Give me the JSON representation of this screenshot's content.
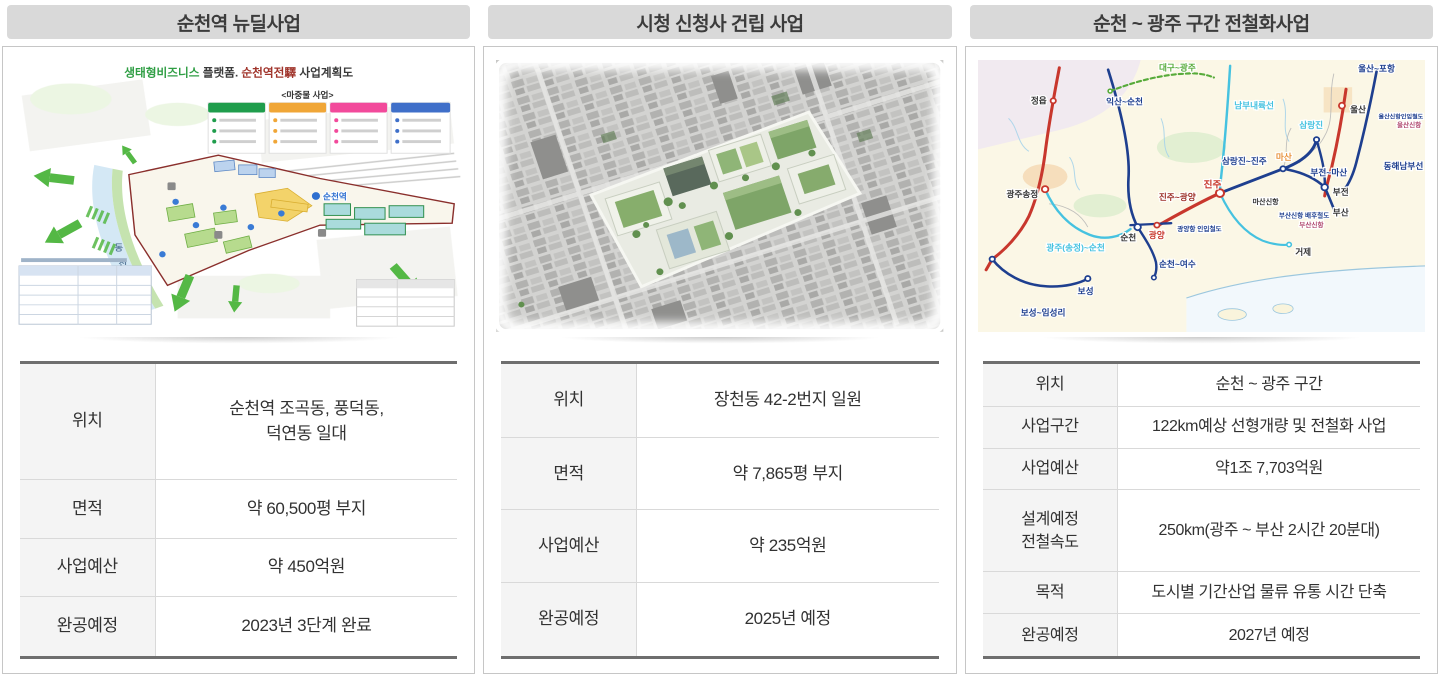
{
  "colors": {
    "header_bar": "#d9d9d9",
    "table_border": "#6e6e6e",
    "table_label_bg": "#f4f4f4",
    "legend_green": "#1f9d4c",
    "legend_orange": "#f0a637",
    "legend_pink": "#f24a9b",
    "legend_blue": "#3f6fc9",
    "rail_red": "#c8372d",
    "rail_navy": "#1e3f8f",
    "rail_cyan": "#45c2e0",
    "rail_green": "#57ab3a"
  },
  "panels": [
    {
      "title": "순천역 뉴딜사업",
      "plan": {
        "title_green": "생태형비즈니스",
        "title_mid": " 플랫폼. ",
        "title_red": "순천역전驛",
        "title_tail": " 사업계획도",
        "legend_heading": "<마중물 사업>",
        "station_label": "순천역",
        "river_char_1": "동",
        "river_char_2": "천"
      },
      "rows": [
        {
          "label": "위치",
          "value": "순천역 조곡동, 풍덕동,\n덕연동 일대"
        },
        {
          "label": "면적",
          "value": "약 60,500평 부지"
        },
        {
          "label": "사업예산",
          "value": "약 450억원"
        },
        {
          "label": "완공예정",
          "value": "2023년 3단계 완료"
        }
      ]
    },
    {
      "title": "시청 신청사 건립 사업",
      "rows": [
        {
          "label": "위치",
          "value": "장천동 42-2번지 일원"
        },
        {
          "label": "면적",
          "value": "약 7,865평 부지"
        },
        {
          "label": "사업예산",
          "value": "약 235억원"
        },
        {
          "label": "완공예정",
          "value": "2025년 예정"
        }
      ]
    },
    {
      "title": "순천 ~ 광주 구간 전철화사업",
      "rail_labels": {
        "jeongeup": "정읍",
        "iksan_suncheon": "익산~순천",
        "daegu_gwangju": "대구~광주",
        "nambu_naeryukseon": "남부내륙선",
        "ulsan_pohang": "울산~포항",
        "ulsan": "울산",
        "ulsan_sinhang_line": "울산신항인입철도",
        "ulsan_sinhang": "울산신항",
        "donghae_nambuseon": "동해남부선",
        "samnangjin": "삼랑진",
        "samnangjin_jinju": "삼랑진~진주",
        "masan": "마산",
        "bujeon_masan": "부전~마산",
        "bujeon": "부전",
        "busan": "부산",
        "masan_sinhang": "마산신항",
        "busan_sinhang_line": "부산신항 배후철도",
        "busan_sinhang": "부산신항",
        "jinju": "진주",
        "jinju_gwangyang": "진주~광양",
        "gwangju_songjeong": "광주송정",
        "gwangju_suncheon": "광주(송정)~순천",
        "suncheon": "순천",
        "gwangyang": "광양",
        "gwangyang_port_line": "광양항 인입철도",
        "suncheon_yeosu": "순천~여수",
        "boseong": "보성",
        "boseong_imseongri": "보성~임성리",
        "geoje": "거제"
      },
      "rows": [
        {
          "label": "위치",
          "value": "순천 ~ 광주 구간"
        },
        {
          "label": "사업구간",
          "value": "122km예상 선형개량 및 전철화 사업"
        },
        {
          "label": "사업예산",
          "value": "약1조 7,703억원"
        },
        {
          "label": "설계예정\n전철속도",
          "value": "250km(광주 ~ 부산 2시간 20분대)"
        },
        {
          "label": "목적",
          "value": "도시별 기간산업 물류 유통 시간 단축"
        },
        {
          "label": "완공예정",
          "value": "2027년 예정"
        }
      ]
    }
  ]
}
